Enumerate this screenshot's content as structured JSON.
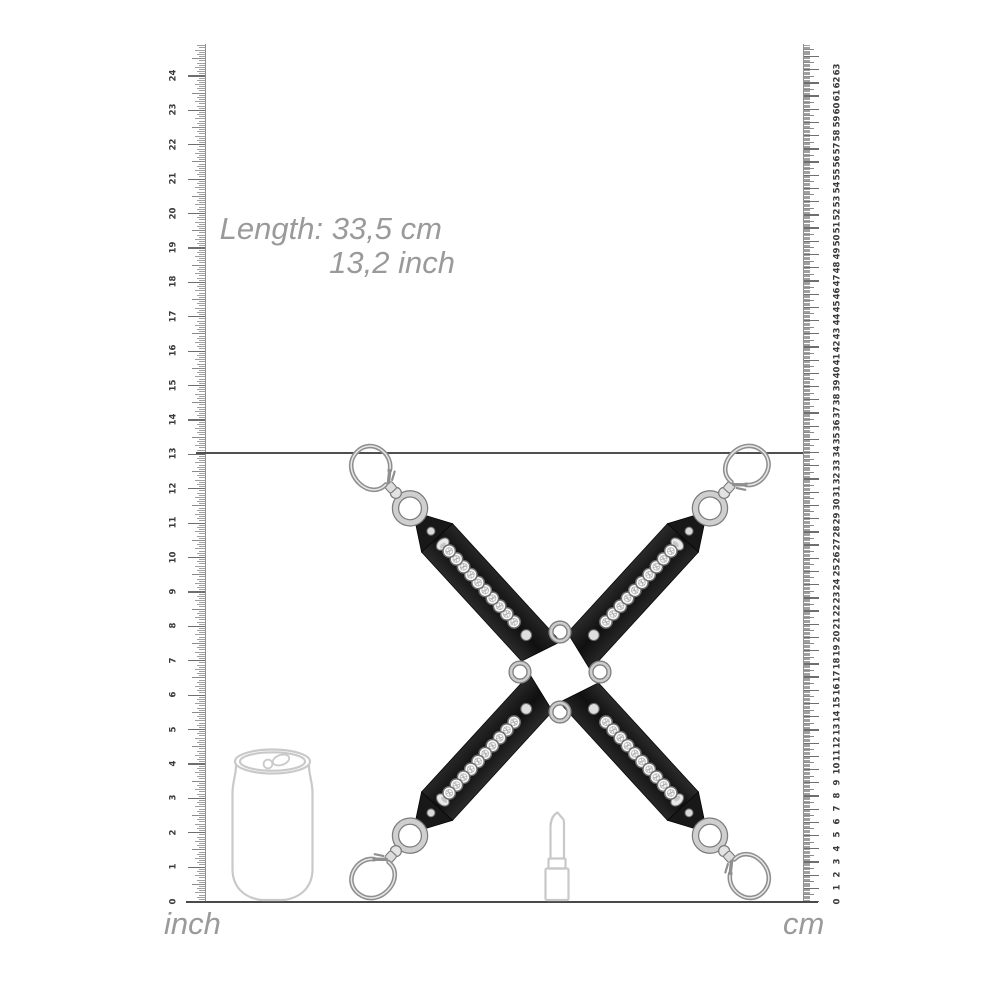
{
  "annotation": {
    "line1": "Length: 33,5 cm",
    "line2": "13,2 inch"
  },
  "rulers": {
    "inch": {
      "unit_label": "inch",
      "numbers": [
        0,
        1,
        2,
        3,
        4,
        5,
        6,
        7,
        8,
        9,
        10,
        11,
        12,
        13,
        14,
        15,
        16,
        17,
        18,
        19,
        20,
        21,
        22,
        23,
        24
      ],
      "ticks_per_unit": 16
    },
    "cm": {
      "unit_label": "cm",
      "numbers": [
        0,
        1,
        2,
        3,
        4,
        5,
        6,
        7,
        8,
        9,
        10,
        11,
        12,
        13,
        14,
        15,
        16,
        17,
        18,
        19,
        20,
        21,
        22,
        23,
        24,
        25,
        26,
        27,
        28,
        29,
        30,
        31,
        32,
        33,
        34,
        35,
        36,
        37,
        38,
        39,
        40,
        41,
        42,
        43,
        44,
        45,
        46,
        47,
        48,
        49,
        50,
        51,
        52,
        53,
        54,
        55,
        56,
        57,
        58,
        59,
        60,
        61,
        62,
        63
      ],
      "ticks_per_unit": 10
    }
  },
  "product": {
    "name": "studded-hogtie-cross",
    "straps": 4,
    "rhinestones_per_strap": 10,
    "center_rings": 4
  },
  "reference_objects": [
    {
      "name": "soda-can"
    },
    {
      "name": "lipstick"
    }
  ],
  "colors": {
    "background": "#ffffff",
    "text_gray": "#9a9a9a",
    "tick_gray": "#a0a0a0",
    "line_dark": "#4a4a4a",
    "strap_black": "#141414",
    "metal_silver": "#c9c9c9",
    "outline_gray": "#c9c9c9"
  }
}
